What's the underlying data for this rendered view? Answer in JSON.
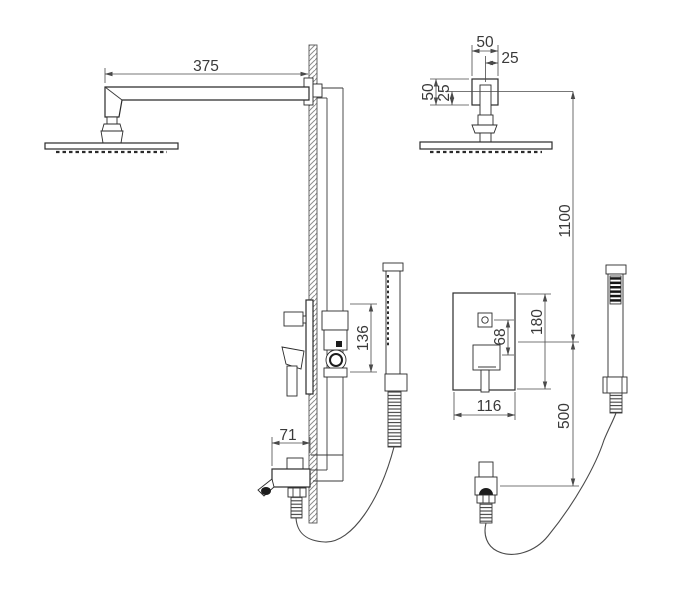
{
  "drawing": {
    "side_view": {
      "dims": {
        "arm_length": "375",
        "valve_trim_height": "136",
        "spout_projection": "71"
      }
    },
    "front_view": {
      "dims": {
        "arm_mount_width": "50",
        "arm_mount_width_half": "25",
        "arm_mount_height": "50",
        "arm_mount_height_half": "25",
        "head_to_valve": "1100",
        "valve_to_outlet": "500",
        "valve_plate_height": "180",
        "button_to_handle": "68",
        "valve_plate_width": "116"
      }
    }
  }
}
